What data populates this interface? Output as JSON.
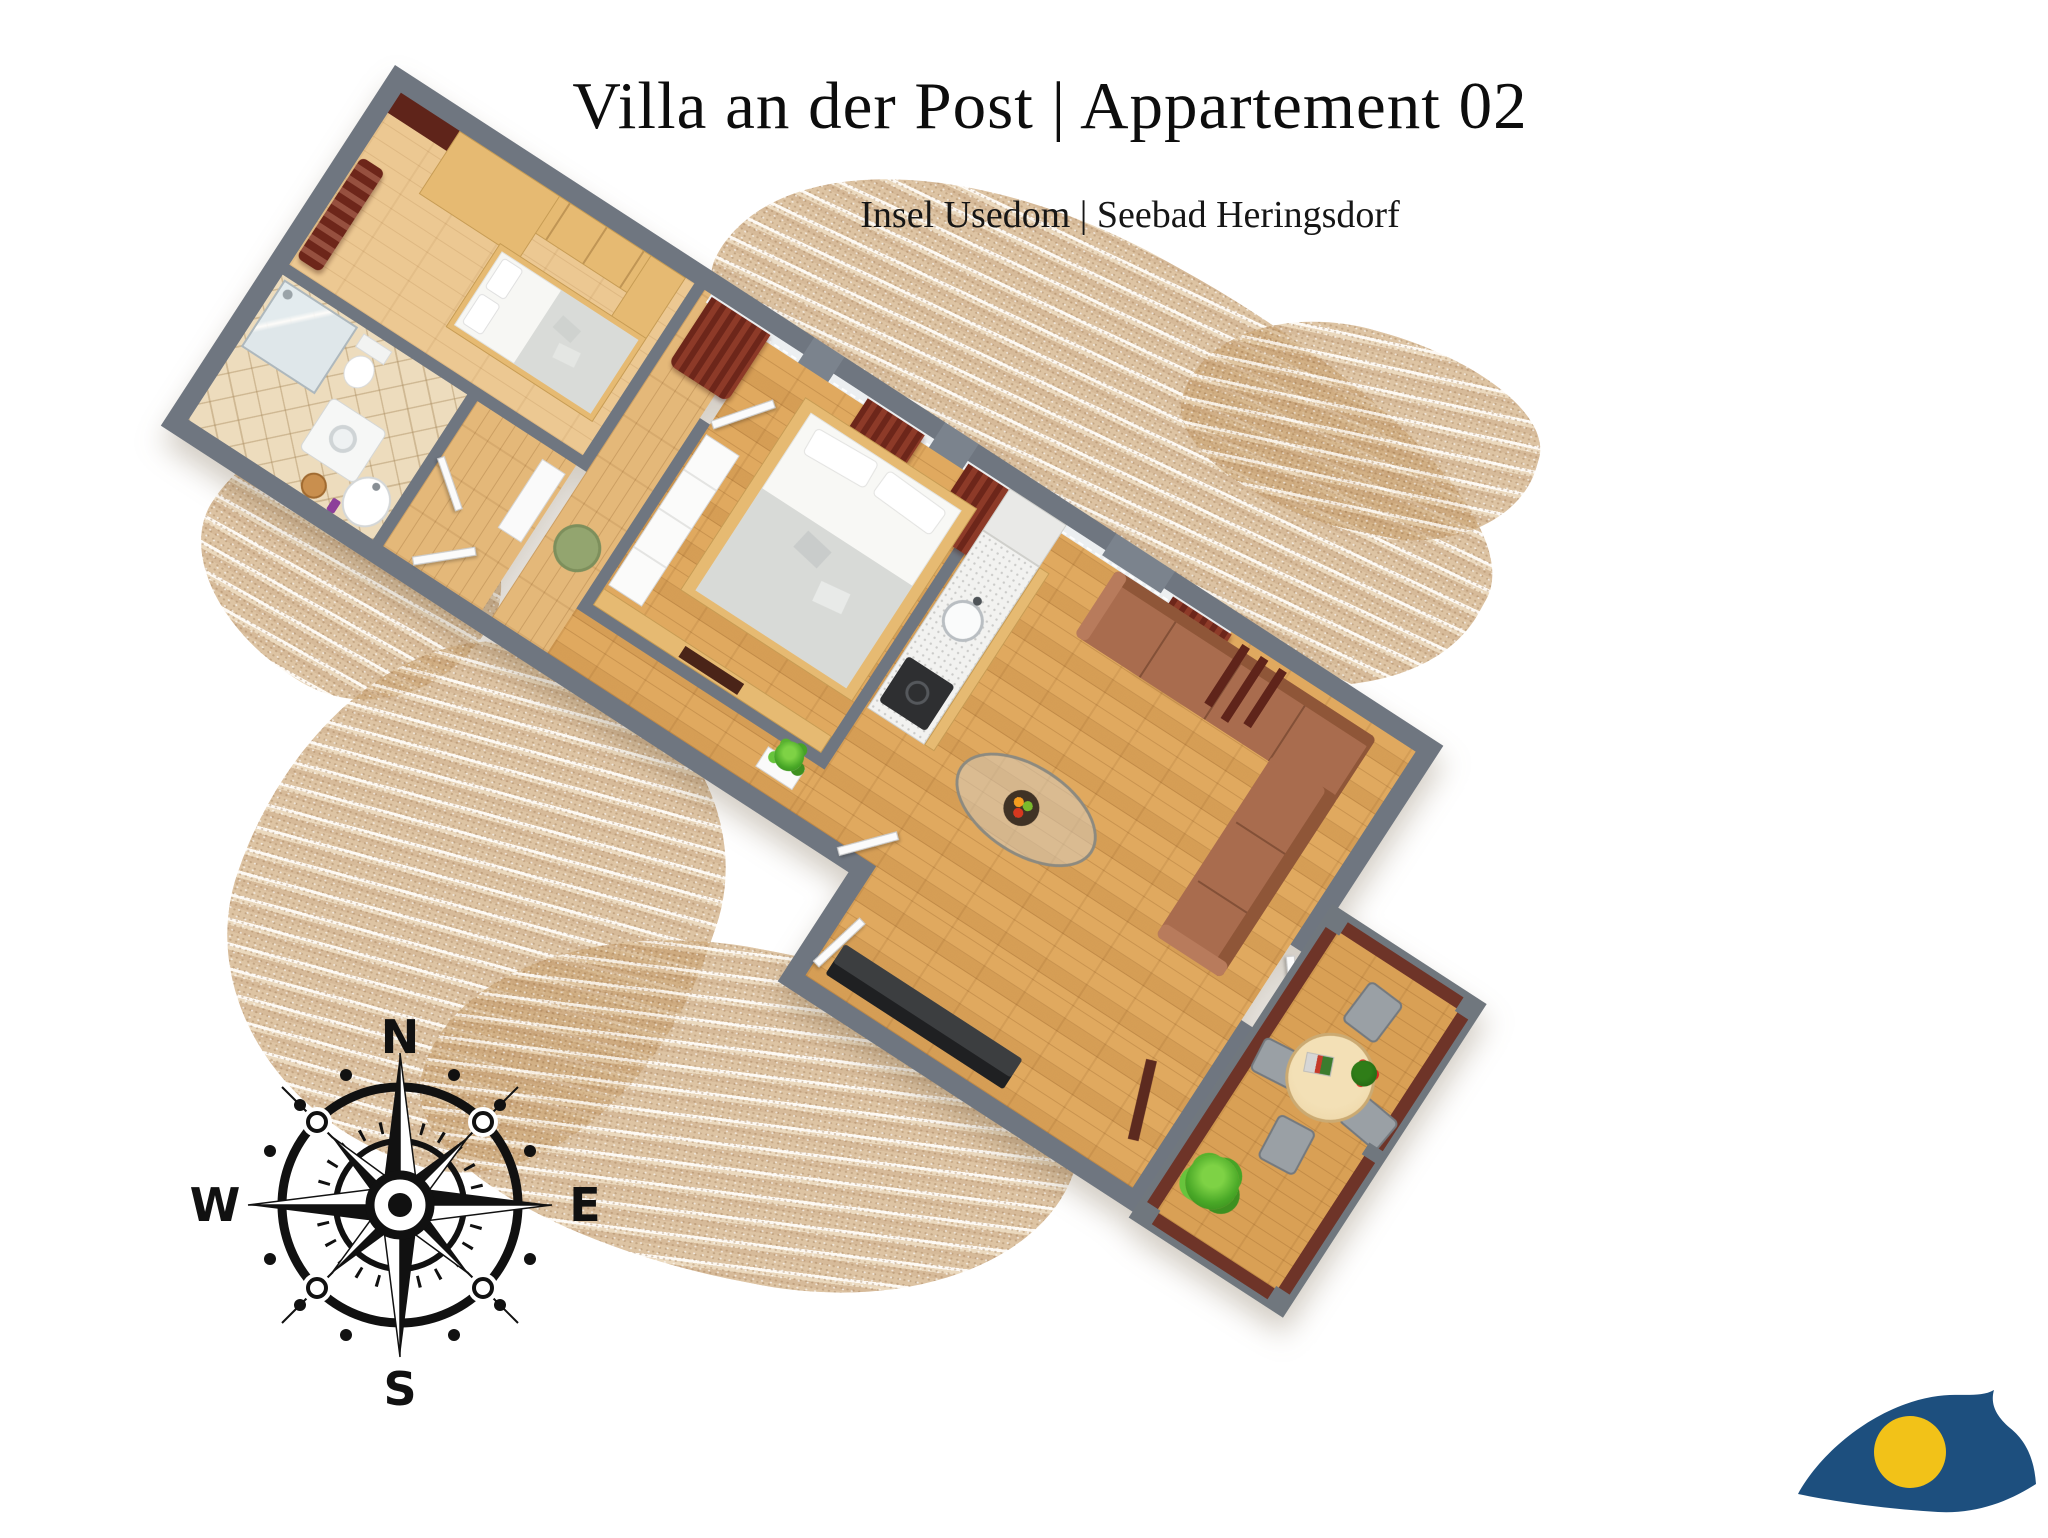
{
  "header": {
    "title": "Villa an der Post | Appartement 02",
    "subtitle": "Insel Usedom | Seebad Heringsdorf"
  },
  "compass": {
    "north": "N",
    "south": "S",
    "east": "E",
    "west": "W"
  },
  "palette": {
    "wall_gray": "#6f7680",
    "wood_light": "#e6ba72",
    "floor_bedroom": "#ecc892",
    "floor_oak": "#e0a95f",
    "bath_tile": "#eddcbd",
    "curtain_maroon": "#6d261a",
    "railing_maroon": "#6e3428",
    "sofa_brown": "#a96c4e",
    "sand": "#c9a87e",
    "logo_blue": "#1d4f7e",
    "logo_yellow": "#f2c218"
  }
}
